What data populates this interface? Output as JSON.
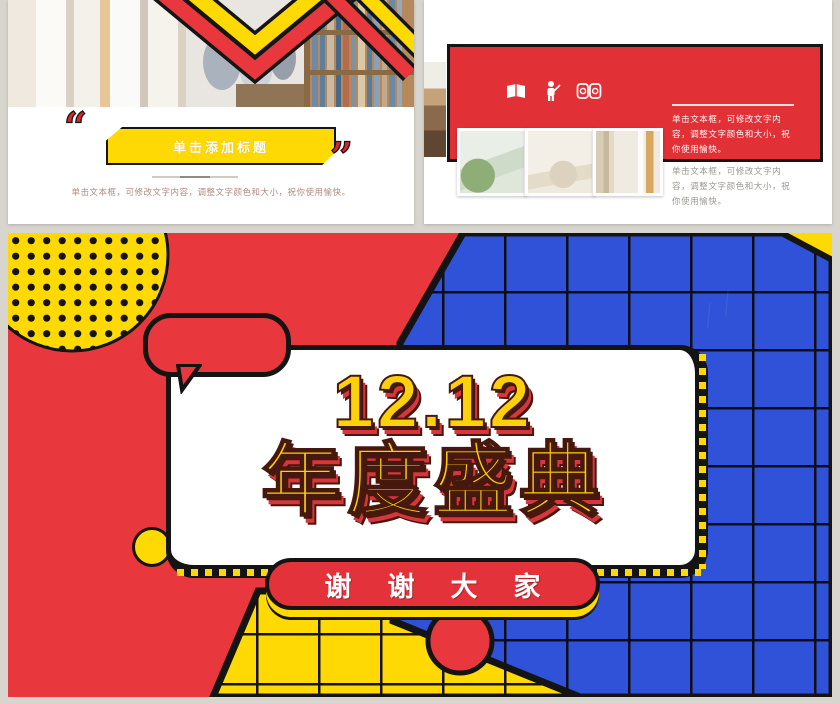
{
  "page": {
    "background": "#d8d4ce",
    "colors": {
      "red": "#e8383e",
      "yellow": "#ffd903",
      "blue": "#2f52d8",
      "black": "#141414",
      "title_yellow": "#fcd10a",
      "title_shadow_red": "#d8363c"
    }
  },
  "slide1": {
    "quote_open": "“",
    "quote_close": "”",
    "banner_title": "单击添加标题",
    "caption": "单击文本框，可修改文字内容，调整文字颜色和大小，祝你使用愉快。"
  },
  "slide2": {
    "icons": [
      "open-book-icon",
      "presenter-icon",
      "reading-book-icon"
    ],
    "caption_on_banner": "单击文本框，可修改文字内容，调整文字颜色和大小，祝你使用愉快。",
    "caption_below": "单击文本框，可修改文字内容，调整文字颜色和大小，祝你使用愉快。"
  },
  "slide3": {
    "title_number": "12.12",
    "title_text": "年度盛典",
    "footer_text": "谢谢大家"
  }
}
